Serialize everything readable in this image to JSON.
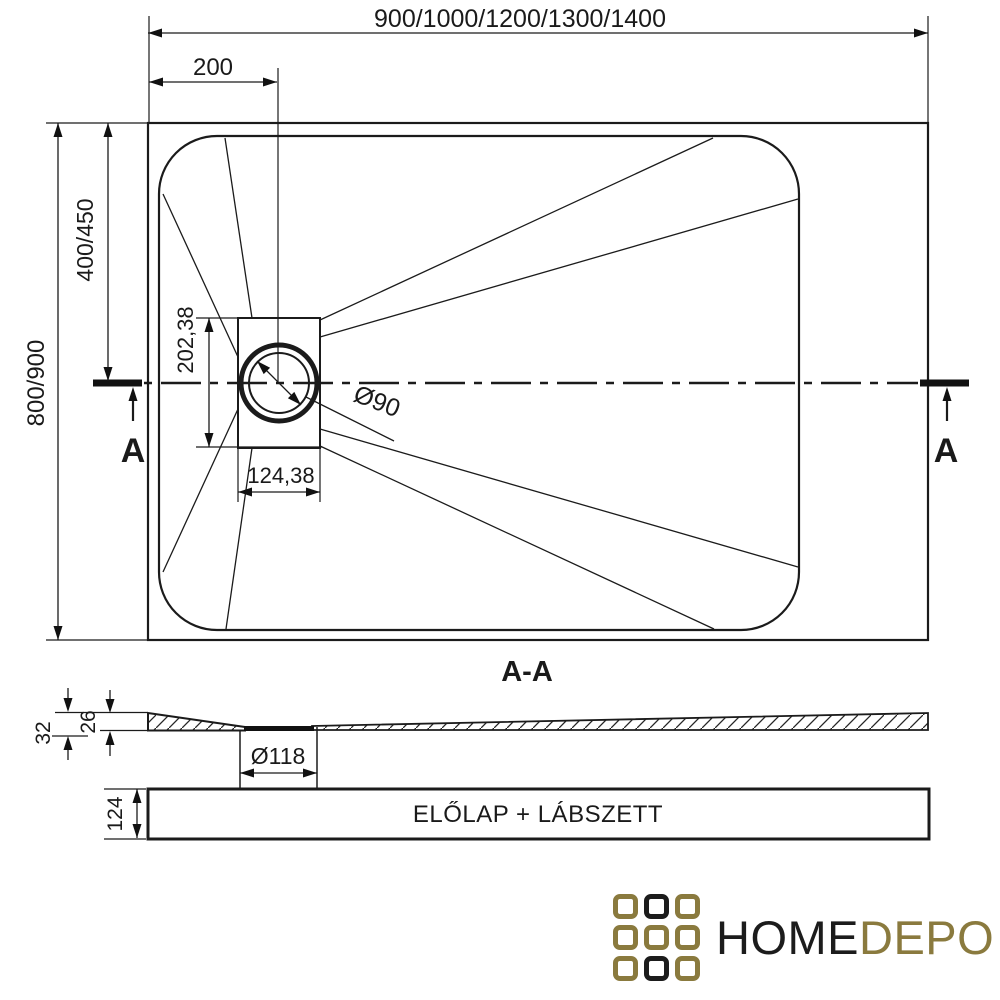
{
  "drawing": {
    "top_view": {
      "dims": {
        "total_width": "900/1000/1200/1300/1400",
        "drain_offset": "200",
        "total_depth": "800/900",
        "drain_center_offset": "400/450",
        "drain_box_height": "202,38",
        "drain_box_width": "124,38",
        "drain_diameter": "Ø90"
      },
      "section_marker": "A"
    },
    "section_view": {
      "label": "A-A",
      "dims": {
        "edge_height": "32",
        "body_height": "26",
        "drain_hole_diameter": "Ø118",
        "panel_height": "124"
      },
      "panel_label": "ELŐLAP + LÁBSZETT"
    }
  },
  "logo": {
    "text_primary": "HOME",
    "text_secondary": "DEPO",
    "colors": {
      "gold": "#8a7a3e",
      "black": "#1c1c1c"
    },
    "grid_pattern": [
      [
        "gold",
        "black",
        "gold"
      ],
      [
        "gold",
        "gold",
        "gold"
      ],
      [
        "gold",
        "black",
        "gold"
      ]
    ]
  }
}
